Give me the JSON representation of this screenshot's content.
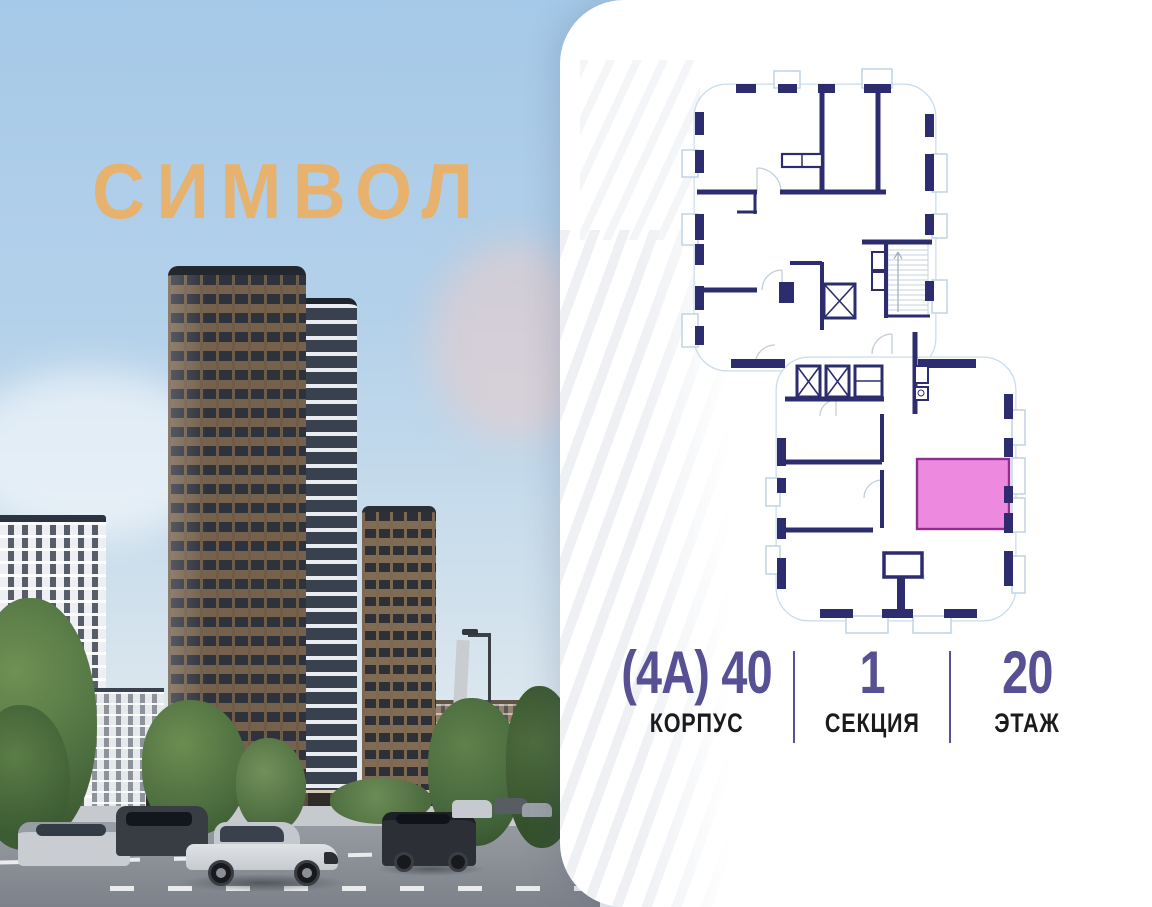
{
  "brand": {
    "logo_text": "СИМВОЛ",
    "logo_color": "#e7b26e"
  },
  "floor_plan": {
    "wall_color": "#2d2c6f",
    "outline_color": "#c9dcea",
    "highlight_fill": "#ed8adf",
    "highlight_border": "#8e2f8f"
  },
  "info": {
    "accent_color": "#575094",
    "label_color": "#1b1b1d",
    "building": {
      "value": "(4А) 40",
      "label": "КОРПУС"
    },
    "section": {
      "value": "1",
      "label": "СЕКЦИЯ"
    },
    "floor": {
      "value": "20",
      "label": "ЭТАЖ"
    }
  }
}
